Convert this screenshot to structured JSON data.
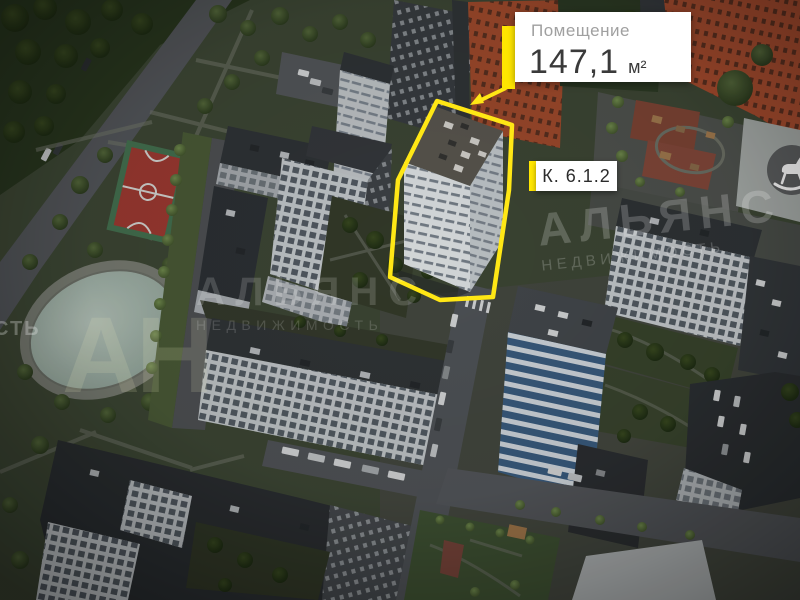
{
  "area_card": {
    "title": "Помещение",
    "value": "147,1",
    "unit": "м²"
  },
  "building_card": {
    "label": "К. 6.1.2"
  },
  "watermarks": {
    "logo": "АН",
    "name": "АЛЬЯНС",
    "type": "НЕДВИЖИМОСТЬ",
    "edge_fragment": "СТЬ"
  },
  "colors": {
    "accent_yellow": "#ffe600",
    "card_bg": "#ffffff",
    "card_title_gray": "#a0a0a0",
    "card_value_dark": "#3a3a3a"
  },
  "icons": {
    "playground_marker": "rocking-horse-icon"
  }
}
